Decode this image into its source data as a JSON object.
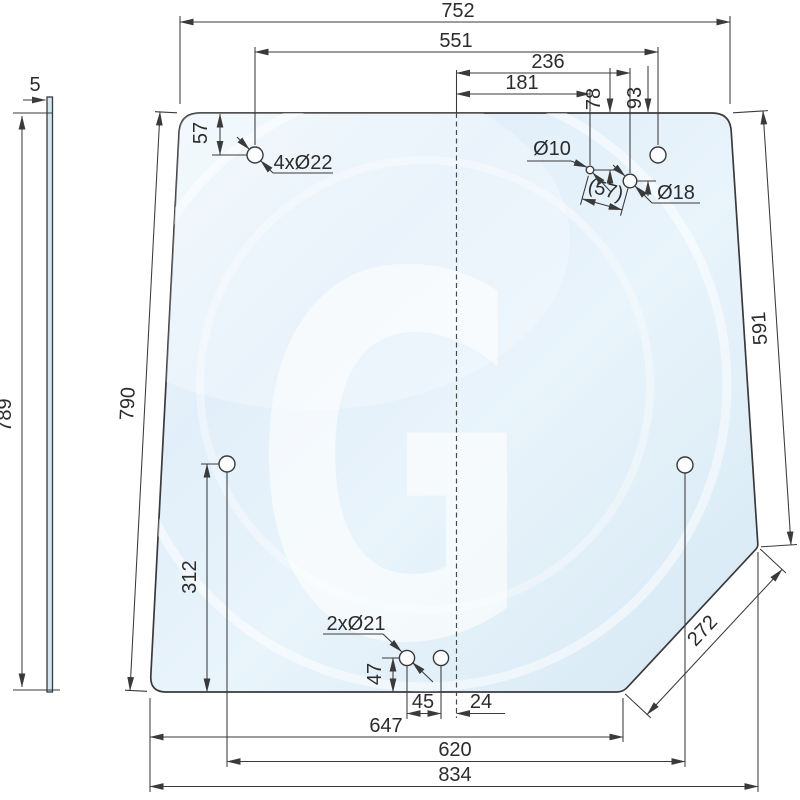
{
  "dimensions": {
    "top_width": "752",
    "top_holes_spacing": "551",
    "hole18_from_center": "236",
    "hole10_from_center": "181",
    "hole10_from_top": "78",
    "hole18_from_top": "93",
    "top_left_hole_from_top": "57",
    "hole_pair_distance": "(57)",
    "right_edge_length": "591",
    "left_edge_length": "790",
    "side_view_height": "789",
    "glass_thickness": "5",
    "mid_hole_from_bottom": "312",
    "bottom_hole_from_bottom": "47",
    "bottom_holes_spacing": "45",
    "bottom_hole_from_center": "24",
    "bottom_edge_width": "647",
    "mid_holes_spacing": "620",
    "overall_width": "834",
    "corner_cut_length": "272"
  },
  "hole_labels": {
    "corner_holes": "4xØ22",
    "small_hole": "Ø10",
    "large_hole": "Ø18",
    "bottom_holes": "2xØ21"
  },
  "watermark": {
    "letter": "G"
  },
  "colors": {
    "line": "#3a3a3a",
    "glass_light": "#eef6fc",
    "glass_dark": "#d7e9f4",
    "watermark": "#ffffff"
  }
}
